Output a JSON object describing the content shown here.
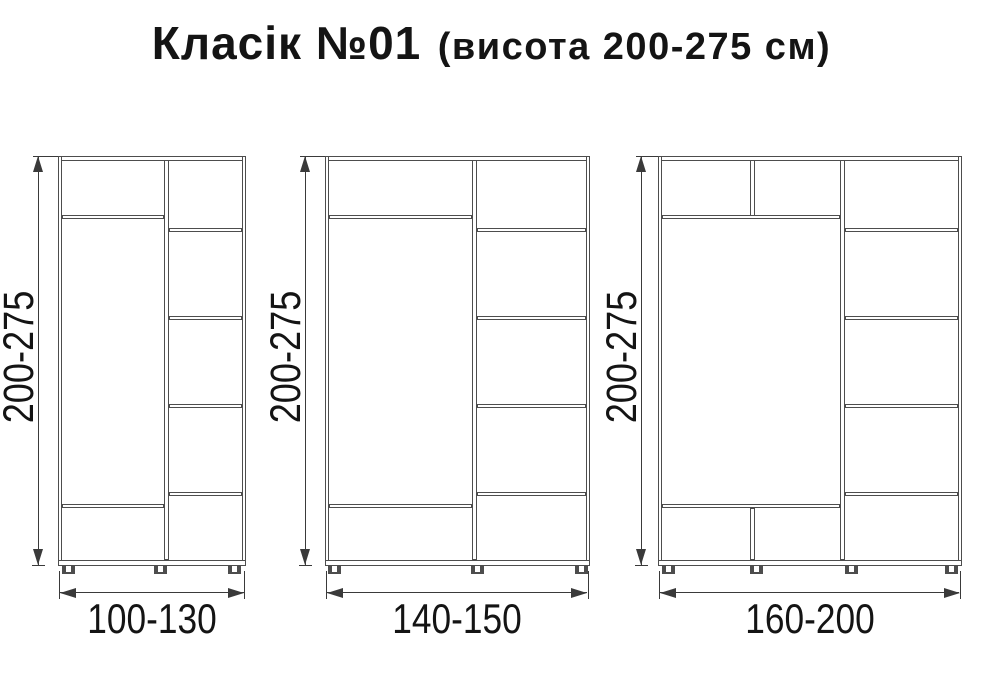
{
  "title": {
    "main": "Класік №01",
    "sub": "(висота 200-275 см)"
  },
  "colors": {
    "panel_line": "#4d4d4d",
    "dimension_line": "#3a3a3a",
    "text": "#141414",
    "background": "#ffffff"
  },
  "wardrobes": [
    {
      "name": "wardrobe-1",
      "height_label": "200-275",
      "width_label": "100-130"
    },
    {
      "name": "wardrobe-2",
      "height_label": "200-275",
      "width_label": "140-150"
    },
    {
      "name": "wardrobe-3",
      "height_label": "200-275",
      "width_label": "160-200"
    }
  ]
}
